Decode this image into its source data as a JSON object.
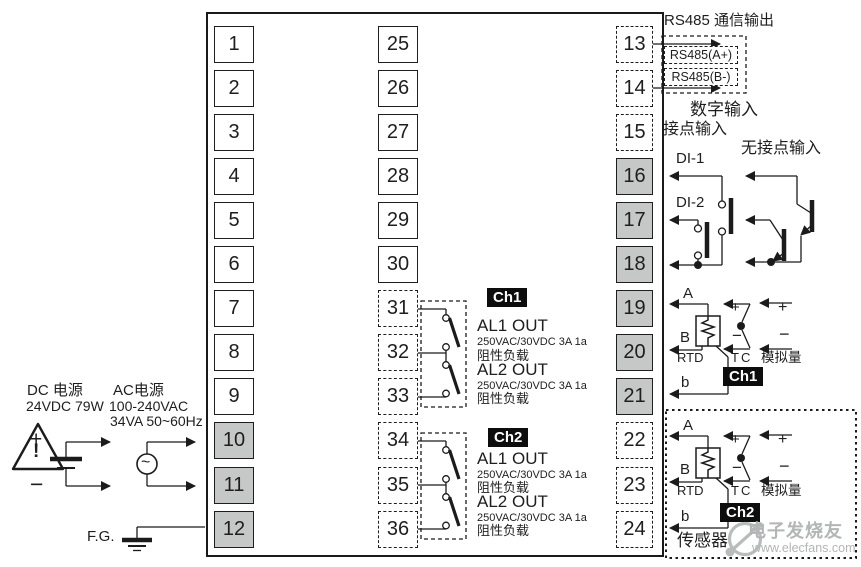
{
  "rs485": {
    "title": "RS485 通信输出",
    "line_a": "RS485(A+)",
    "line_b": "RS485(B-)"
  },
  "digital_input": {
    "title": "数字输入",
    "contact_label": "接点输入",
    "contactless_label": "无接点输入",
    "di1": "DI-1",
    "di2": "DI-2"
  },
  "power": {
    "dc_title": "DC 电源",
    "dc_spec": "24VDC 79W",
    "ac_title": "AC电源",
    "ac_spec_1": "100-240VAC",
    "ac_spec_2": "34VA 50~60Hz",
    "fg_label": "F.G.",
    "plus": "+",
    "minus": "−",
    "warning": "!",
    "ac_wave": "~"
  },
  "alarm_output": {
    "ch1": {
      "badge": "Ch1",
      "al1_label": "AL1 OUT",
      "al1_rating": "250VAC/30VDC 3A 1a",
      "al1_load": "阻性负载",
      "al2_label": "AL2 OUT",
      "al2_rating": "250VAC/30VDC 3A 1a",
      "al2_load": "阻性负载"
    },
    "ch2": {
      "badge": "Ch2",
      "al1_label": "AL1 OUT",
      "al1_rating": "250VAC/30VDC 3A 1a",
      "al1_load": "阻性负载",
      "al2_label": "AL2 OUT",
      "al2_rating": "250VAC/30VDC 3A 1a",
      "al2_load": "阻性负载"
    }
  },
  "sensor_input": {
    "ch1": {
      "badge": "Ch1",
      "terminal_a": "A",
      "terminal_b": "B",
      "terminal_b2": "b",
      "rtd_label": "RTD",
      "tc_label": "TC",
      "analog_label": "模拟量",
      "plus": "+",
      "minus": "−"
    },
    "ch2": {
      "badge": "Ch2",
      "terminal_a": "A",
      "terminal_b": "B",
      "terminal_b2": "b",
      "rtd_label": "RTD",
      "tc_label": "TC",
      "analog_label": "模拟量",
      "plus": "+",
      "minus": "−",
      "sensor_label": "传感器"
    }
  },
  "terminals": {
    "left_column": [
      {
        "label": "1",
        "variant": "plain"
      },
      {
        "label": "2",
        "variant": "plain"
      },
      {
        "label": "3",
        "variant": "plain"
      },
      {
        "label": "4",
        "variant": "plain"
      },
      {
        "label": "5",
        "variant": "plain"
      },
      {
        "label": "6",
        "variant": "plain"
      },
      {
        "label": "7",
        "variant": "plain"
      },
      {
        "label": "8",
        "variant": "plain"
      },
      {
        "label": "9",
        "variant": "plain"
      },
      {
        "label": "10",
        "variant": "power"
      },
      {
        "label": "11",
        "variant": "power"
      },
      {
        "label": "12",
        "variant": "power"
      }
    ],
    "middle_column": [
      {
        "label": "25",
        "variant": "plain"
      },
      {
        "label": "26",
        "variant": "plain"
      },
      {
        "label": "27",
        "variant": "plain"
      },
      {
        "label": "28",
        "variant": "plain"
      },
      {
        "label": "29",
        "variant": "plain"
      },
      {
        "label": "30",
        "variant": "plain"
      },
      {
        "label": "31",
        "variant": "dashed"
      },
      {
        "label": "32",
        "variant": "dashed"
      },
      {
        "label": "33",
        "variant": "dashed"
      },
      {
        "label": "34",
        "variant": "dashed"
      },
      {
        "label": "35",
        "variant": "dashed"
      },
      {
        "label": "36",
        "variant": "dashed"
      }
    ],
    "right_column": [
      {
        "label": "13",
        "variant": "dashed"
      },
      {
        "label": "14",
        "variant": "dashed"
      },
      {
        "label": "15",
        "variant": "dashed"
      },
      {
        "label": "16",
        "variant": "power"
      },
      {
        "label": "17",
        "variant": "power"
      },
      {
        "label": "18",
        "variant": "power"
      },
      {
        "label": "19",
        "variant": "power"
      },
      {
        "label": "20",
        "variant": "power"
      },
      {
        "label": "21",
        "variant": "power"
      },
      {
        "label": "22",
        "variant": "dashed"
      },
      {
        "label": "23",
        "variant": "dashed"
      },
      {
        "label": "24",
        "variant": "dashed"
      }
    ]
  },
  "watermark": {
    "brand": "电子发烧友",
    "url": "www.elecfans.com"
  },
  "colors": {
    "terminal_fill_power": "#c6c7c7",
    "badge_bg": "#0d0d0d",
    "wire": "#1b1b1b",
    "watermark_gray": "#b3b6b6"
  }
}
